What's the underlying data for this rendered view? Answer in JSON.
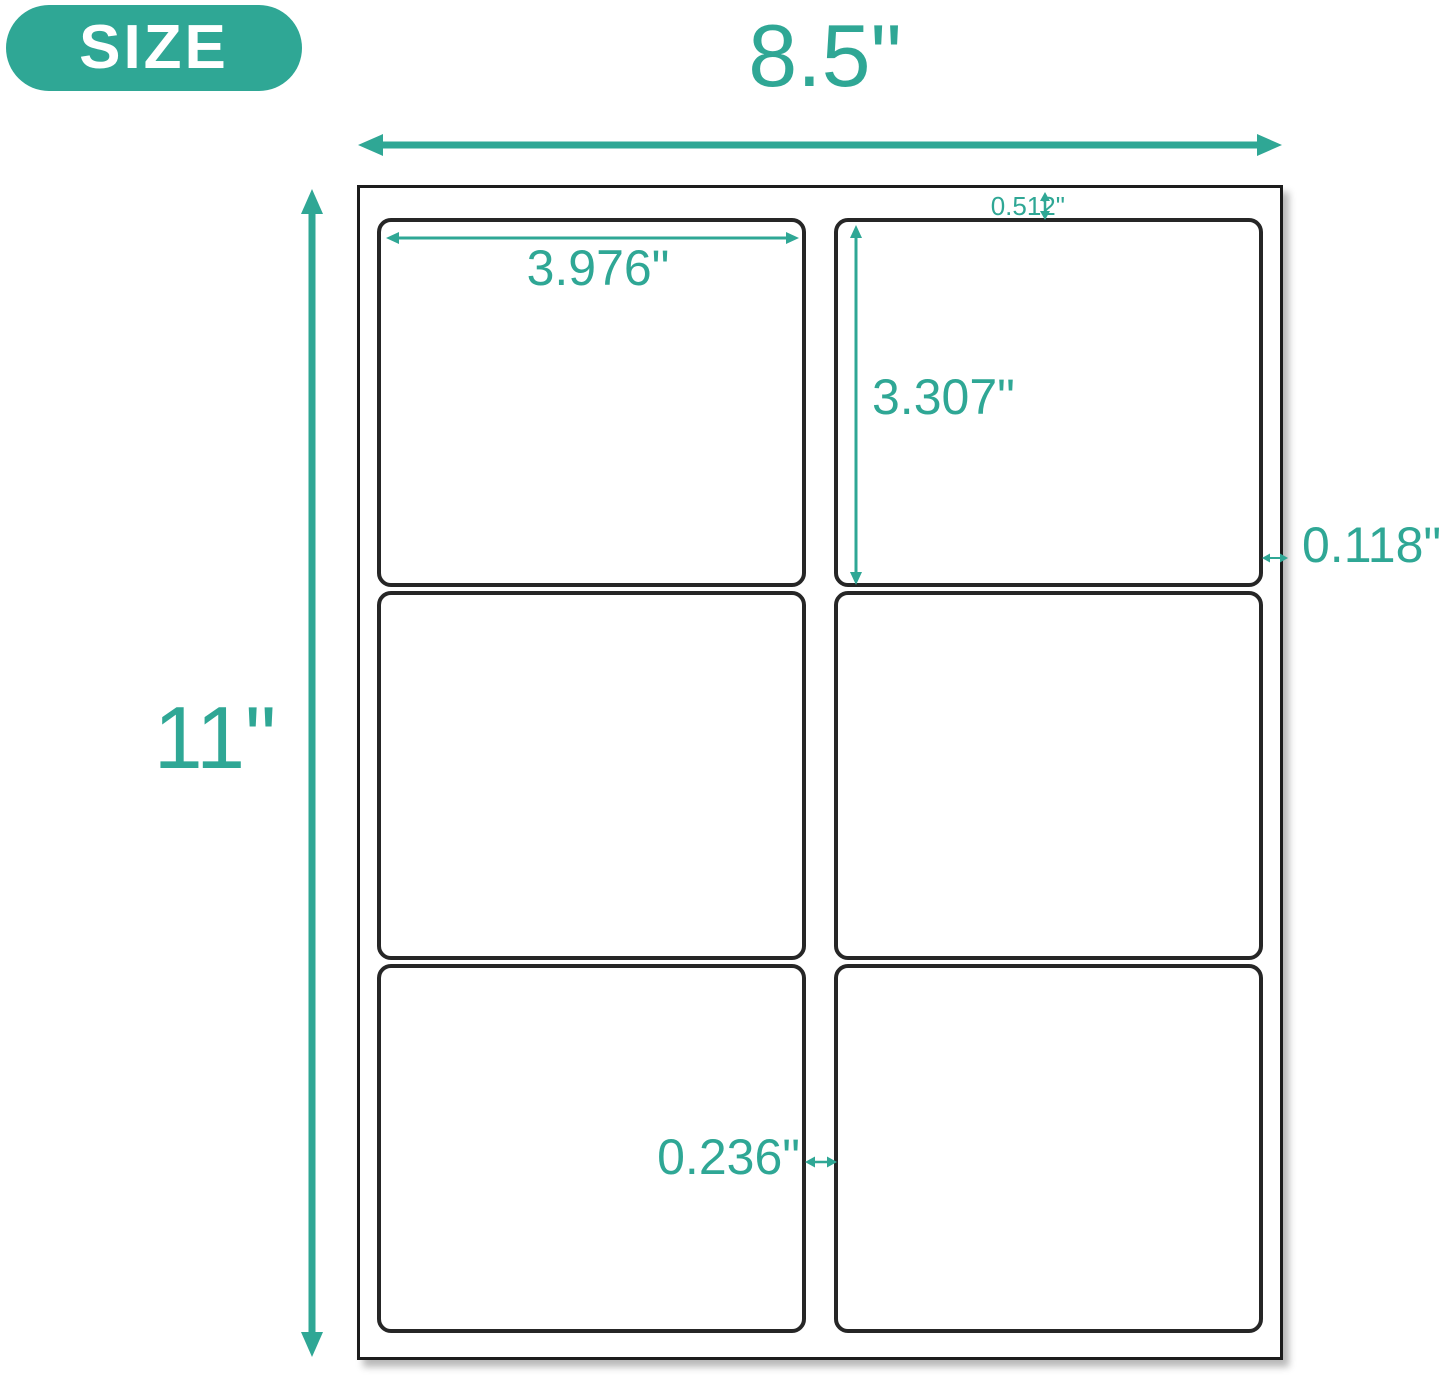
{
  "badge": {
    "label": "SIZE"
  },
  "colors": {
    "accent": "#2FA795",
    "sheet_border": "#1c1c1c",
    "label_border": "#262626",
    "background": "#ffffff",
    "badge_text": "#ffffff"
  },
  "sheet": {
    "rows": 3,
    "columns": 2,
    "label_count": 6
  },
  "dimensions": {
    "sheet_width": "8.5\"",
    "sheet_height": "11\"",
    "label_width": "3.976\"",
    "label_height": "3.307\"",
    "top_margin": "0.512\"",
    "side_margin": "0.118\"",
    "column_gap": "0.236\""
  }
}
